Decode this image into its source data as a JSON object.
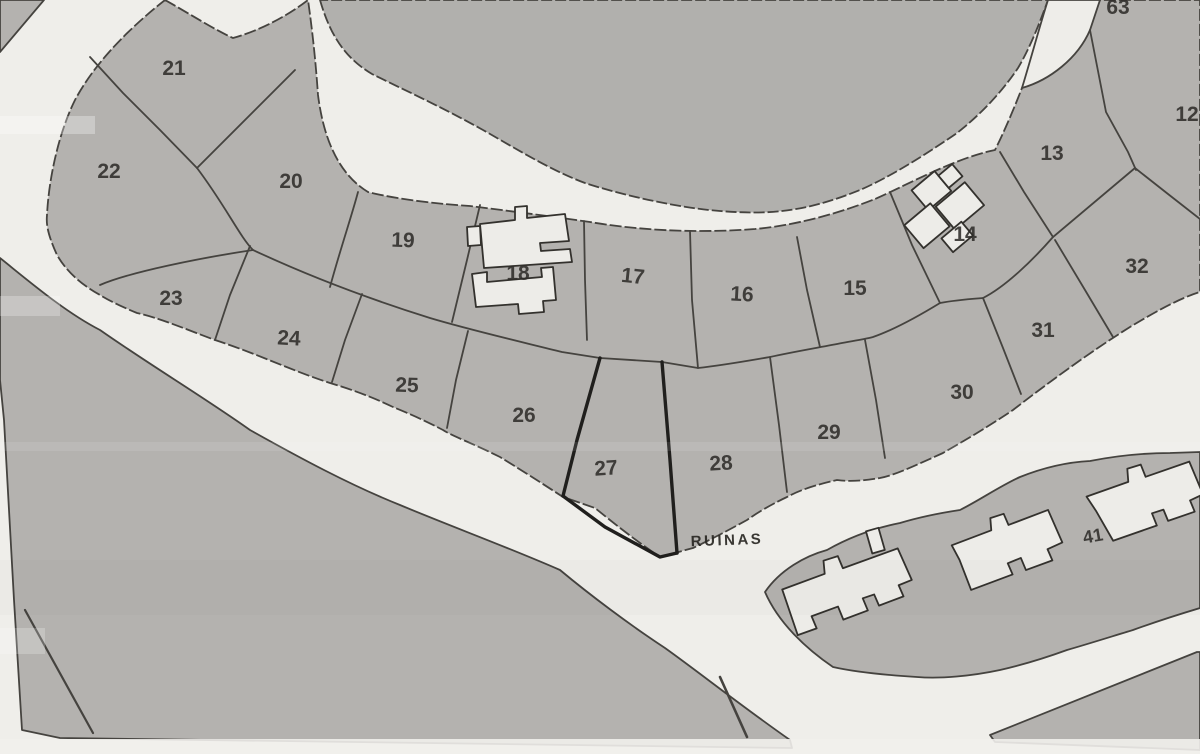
{
  "map": {
    "description_label": "RUINAS",
    "parcels": [
      {
        "number": "12"
      },
      {
        "number": "13"
      },
      {
        "number": "14"
      },
      {
        "number": "15"
      },
      {
        "number": "16"
      },
      {
        "number": "17"
      },
      {
        "number": "18"
      },
      {
        "number": "19"
      },
      {
        "number": "20"
      },
      {
        "number": "21"
      },
      {
        "number": "22"
      },
      {
        "number": "23"
      },
      {
        "number": "24"
      },
      {
        "number": "25"
      },
      {
        "number": "26"
      },
      {
        "number": "27"
      },
      {
        "number": "28"
      },
      {
        "number": "29"
      },
      {
        "number": "30"
      },
      {
        "number": "31"
      },
      {
        "number": "32"
      },
      {
        "number": "41"
      },
      {
        "number": "63"
      }
    ],
    "colors": {
      "parcel_fill": "#b4b2af",
      "blob_fill": "#b1b0ad",
      "road_fill": "#eeede9",
      "boundary_line": "#45433f",
      "bold_boundary_line": "#201f1d",
      "label_color": "#2f2d2a"
    }
  }
}
